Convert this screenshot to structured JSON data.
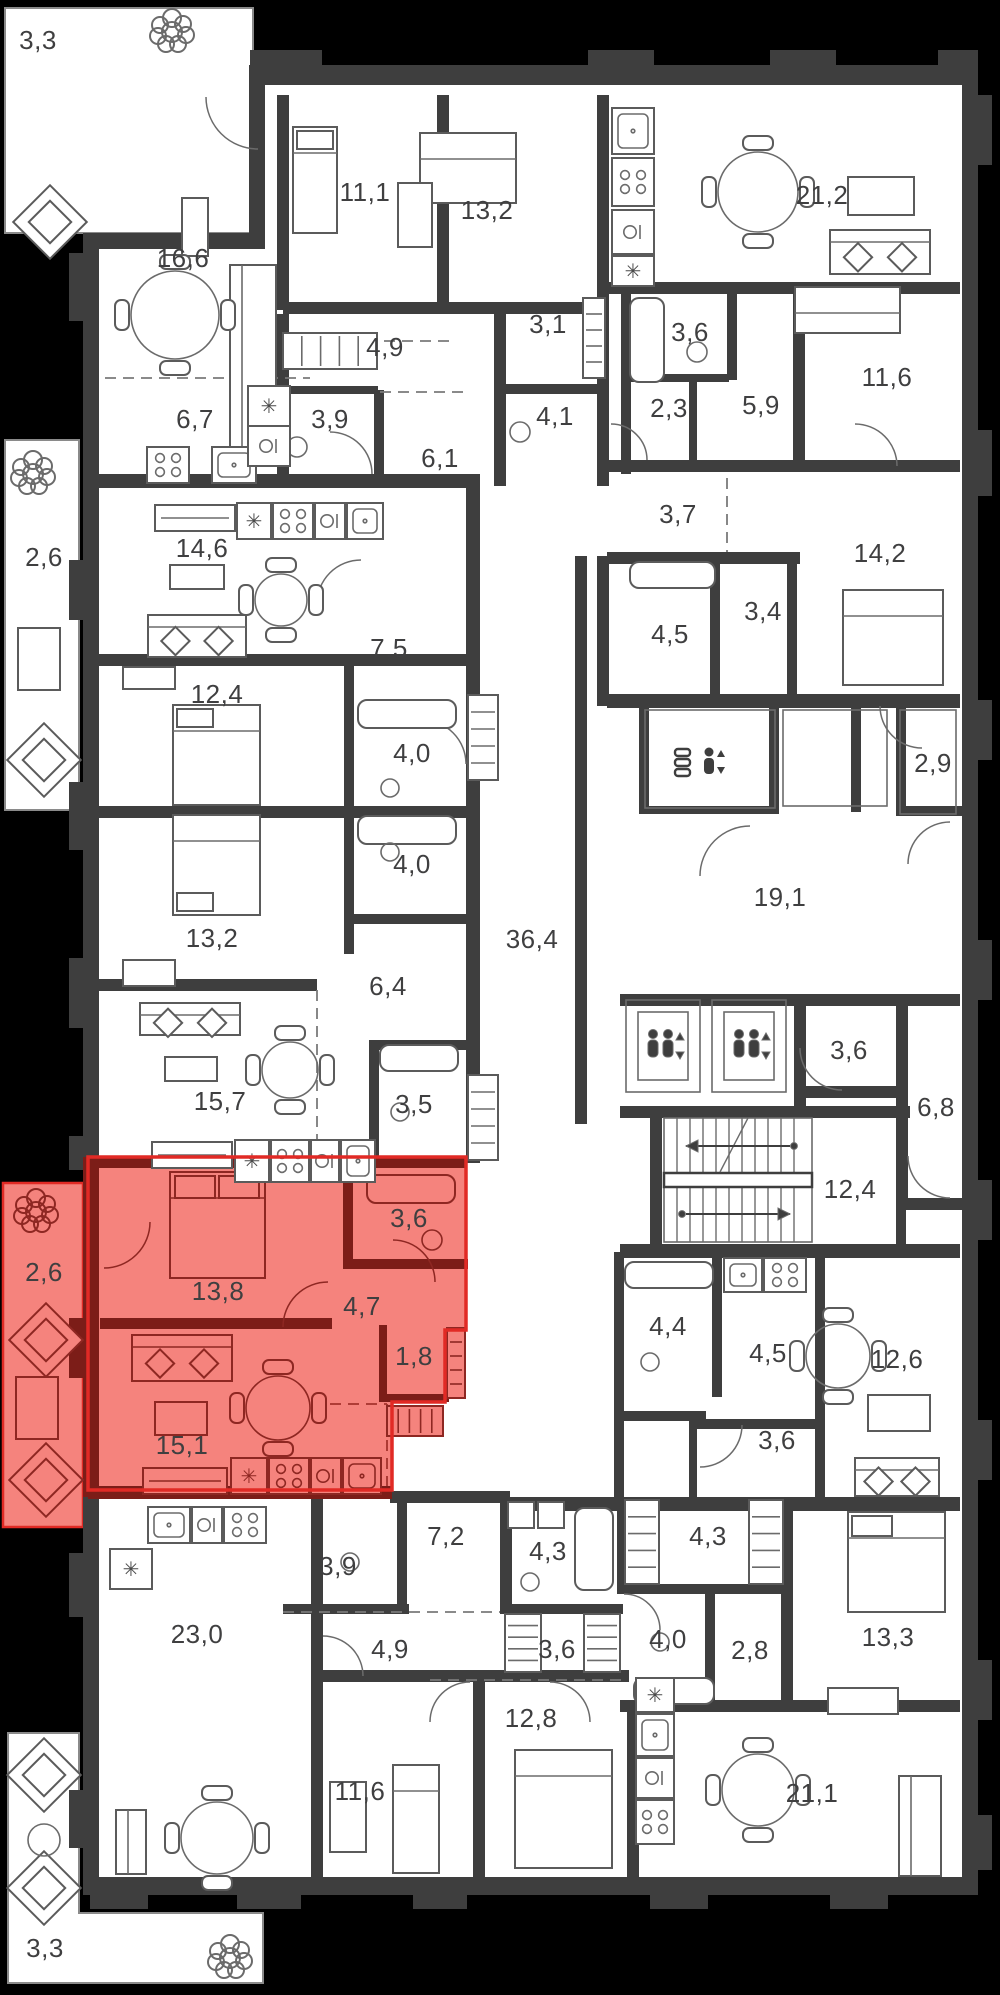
{
  "plan": {
    "background": "#000000",
    "wall_color": "#3e3e3e",
    "text_color": "#3f3f40",
    "highlight": {
      "fill": "#f5837d",
      "wall": "#7c1d18",
      "outline": "#e12a25",
      "meaning": "selected-apartment"
    },
    "glyphs": {
      "vent-star-icon": "✳"
    },
    "room_labels": [
      {
        "id": "terrace-top",
        "label": "3,3",
        "x": 38,
        "y": 40
      },
      {
        "id": "living-16-6",
        "label": "16,6",
        "x": 183,
        "y": 258
      },
      {
        "id": "bedroom-11-1",
        "label": "11,1",
        "x": 365,
        "y": 192
      },
      {
        "id": "bedroom-13-2-top",
        "label": "13,2",
        "x": 487,
        "y": 210
      },
      {
        "id": "living-21-2",
        "label": "21,2",
        "x": 822,
        "y": 195
      },
      {
        "id": "hall-4-9-top",
        "label": "4,9",
        "x": 385,
        "y": 347
      },
      {
        "id": "room-3-1",
        "label": "3,1",
        "x": 548,
        "y": 324
      },
      {
        "id": "bath-3-6-top",
        "label": "3,6",
        "x": 690,
        "y": 332
      },
      {
        "id": "bedroom-11-6-top",
        "label": "11,6",
        "x": 887,
        "y": 377
      },
      {
        "id": "kitchen-6-7",
        "label": "6,7",
        "x": 195,
        "y": 419
      },
      {
        "id": "bath-3-9-top",
        "label": "3,9",
        "x": 330,
        "y": 419
      },
      {
        "id": "bath-4-1",
        "label": "4,1",
        "x": 555,
        "y": 416
      },
      {
        "id": "room-2-3",
        "label": "2,3",
        "x": 669,
        "y": 408
      },
      {
        "id": "hall-5-9",
        "label": "5,9",
        "x": 761,
        "y": 405
      },
      {
        "id": "hall-6-1",
        "label": "6,1",
        "x": 440,
        "y": 458
      },
      {
        "id": "room-3-7",
        "label": "3,7",
        "x": 678,
        "y": 514
      },
      {
        "id": "balcony-2-6-left",
        "label": "2,6",
        "x": 44,
        "y": 557
      },
      {
        "id": "living-14-6",
        "label": "14,6",
        "x": 202,
        "y": 548
      },
      {
        "id": "bedroom-14-2",
        "label": "14,2",
        "x": 880,
        "y": 553
      },
      {
        "id": "wardrobe-3-4",
        "label": "3,4",
        "x": 763,
        "y": 611
      },
      {
        "id": "bath-4-5-mid",
        "label": "4,5",
        "x": 670,
        "y": 634
      },
      {
        "id": "hall-7-5",
        "label": "7,5",
        "x": 389,
        "y": 648
      },
      {
        "id": "bedroom-12-4",
        "label": "12,4",
        "x": 217,
        "y": 694
      },
      {
        "id": "bath-4-0-upper",
        "label": "4,0",
        "x": 412,
        "y": 753
      },
      {
        "id": "room-2-9",
        "label": "2,9",
        "x": 933,
        "y": 763
      },
      {
        "id": "bath-4-0-lower",
        "label": "4,0",
        "x": 412,
        "y": 864
      },
      {
        "id": "living-19-1",
        "label": "19,1",
        "x": 780,
        "y": 897
      },
      {
        "id": "bedroom-13-2-left",
        "label": "13,2",
        "x": 212,
        "y": 938
      },
      {
        "id": "corridor-36-4",
        "label": "36,4",
        "x": 532,
        "y": 939
      },
      {
        "id": "hall-6-4",
        "label": "6,4",
        "x": 388,
        "y": 986
      },
      {
        "id": "room-3-6-lobby",
        "label": "3,6",
        "x": 849,
        "y": 1050
      },
      {
        "id": "living-15-7",
        "label": "15,7",
        "x": 220,
        "y": 1101
      },
      {
        "id": "bath-3-5",
        "label": "3,5",
        "x": 414,
        "y": 1104
      },
      {
        "id": "room-6-8",
        "label": "6,8",
        "x": 936,
        "y": 1107
      },
      {
        "id": "stairs-12-4",
        "label": "12,4",
        "x": 850,
        "y": 1189
      },
      {
        "id": "balcony-2-6-red",
        "label": "2,6",
        "x": 44,
        "y": 1272,
        "zone": "red"
      },
      {
        "id": "bath-3-6-red",
        "label": "3,6",
        "x": 409,
        "y": 1218,
        "zone": "red"
      },
      {
        "id": "bedroom-13-8-red",
        "label": "13,8",
        "x": 218,
        "y": 1291,
        "zone": "red"
      },
      {
        "id": "hall-4-7-red",
        "label": "4,7",
        "x": 362,
        "y": 1306,
        "zone": "red"
      },
      {
        "id": "wardrobe-1-8-red",
        "label": "1,8",
        "x": 414,
        "y": 1356,
        "zone": "red"
      },
      {
        "id": "bath-4-4",
        "label": "4,4",
        "x": 668,
        "y": 1326
      },
      {
        "id": "kitchen-4-5",
        "label": "4,5",
        "x": 768,
        "y": 1353
      },
      {
        "id": "living-12-6",
        "label": "12,6",
        "x": 897,
        "y": 1359
      },
      {
        "id": "living-15-1-red",
        "label": "15,1",
        "x": 182,
        "y": 1445,
        "zone": "red"
      },
      {
        "id": "hall-3-6-br",
        "label": "3,6",
        "x": 777,
        "y": 1440
      },
      {
        "id": "hall-7-2",
        "label": "7,2",
        "x": 446,
        "y": 1536
      },
      {
        "id": "bath-4-3-left",
        "label": "4,3",
        "x": 548,
        "y": 1551
      },
      {
        "id": "wardrobe-4-3-right",
        "label": "4,3",
        "x": 708,
        "y": 1536
      },
      {
        "id": "bath-3-9-bottom",
        "label": "3,9",
        "x": 338,
        "y": 1566
      },
      {
        "id": "living-23-0",
        "label": "23,0",
        "x": 197,
        "y": 1634
      },
      {
        "id": "bath-4-0-bottom",
        "label": "4,0",
        "x": 668,
        "y": 1639
      },
      {
        "id": "hall-2-8",
        "label": "2,8",
        "x": 750,
        "y": 1650
      },
      {
        "id": "bedroom-13-3",
        "label": "13,3",
        "x": 888,
        "y": 1637
      },
      {
        "id": "hall-4-9-bottom",
        "label": "4,9",
        "x": 390,
        "y": 1649
      },
      {
        "id": "wardrobe-3-6-bottom",
        "label": "3,6",
        "x": 557,
        "y": 1649
      },
      {
        "id": "bedroom-12-8",
        "label": "12,8",
        "x": 531,
        "y": 1718
      },
      {
        "id": "bedroom-11-6-bottom",
        "label": "11,6",
        "x": 360,
        "y": 1791
      },
      {
        "id": "living-21-1",
        "label": "21,1",
        "x": 812,
        "y": 1793
      },
      {
        "id": "balcony-3-3-bottom",
        "label": "3,3",
        "x": 45,
        "y": 1948
      }
    ],
    "icons": [
      {
        "name": "tree-icon",
        "x": 172,
        "y": 32
      },
      {
        "name": "tree-icon",
        "x": 33,
        "y": 474
      },
      {
        "name": "tree-icon",
        "x": 36,
        "y": 1212,
        "zone": "red"
      },
      {
        "name": "tree-icon",
        "x": 230,
        "y": 1958
      },
      {
        "name": "elevator-passenger-icon",
        "x": 663,
        "y": 1046
      },
      {
        "name": "elevator-passenger-icon",
        "x": 749,
        "y": 1046
      },
      {
        "name": "elevator-freight-icon",
        "x": 709,
        "y": 762
      },
      {
        "name": "stairs-icon",
        "x": 738,
        "y": 1180
      }
    ]
  }
}
